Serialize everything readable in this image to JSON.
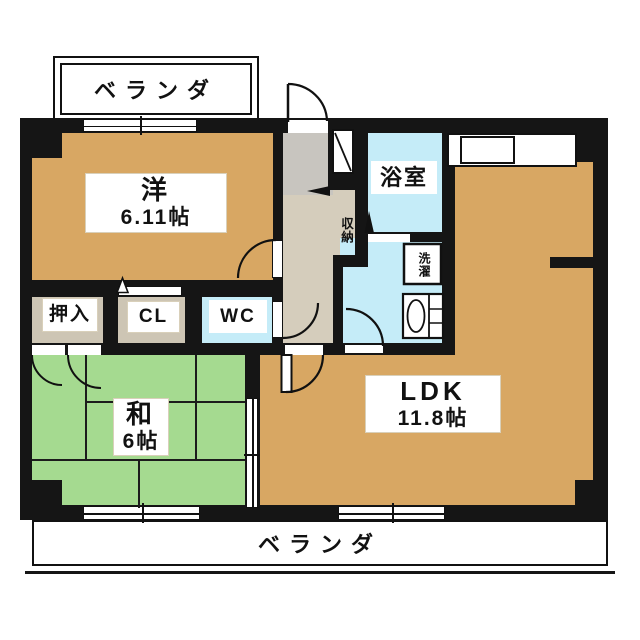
{
  "palette": {
    "wall": "#151515",
    "flooring_tan": "#D8A763",
    "tatami_green": "#A5DA90",
    "water_area_blue": "#C5ECF8",
    "corridor_beige": "#D5CDBC",
    "entrance_gray": "#C8C5BF",
    "closet_beige": "#CDC5B4"
  },
  "balcony_top": {
    "label": "ベランダ"
  },
  "balcony_bottom": {
    "label": "ベランダ"
  },
  "rooms": {
    "western": {
      "name": "洋",
      "size": "6.11帖"
    },
    "japanese": {
      "name": "和",
      "size": "6帖"
    },
    "ldk": {
      "name": "LDK",
      "size": "11.8帖"
    },
    "bathroom": {
      "label": "浴室"
    },
    "storage": {
      "label": "収納"
    },
    "laundry": {
      "label": "洗濯"
    },
    "oshiire": {
      "label": "押入"
    },
    "closet": {
      "label": "CL"
    },
    "toilet": {
      "label": "WC"
    }
  }
}
